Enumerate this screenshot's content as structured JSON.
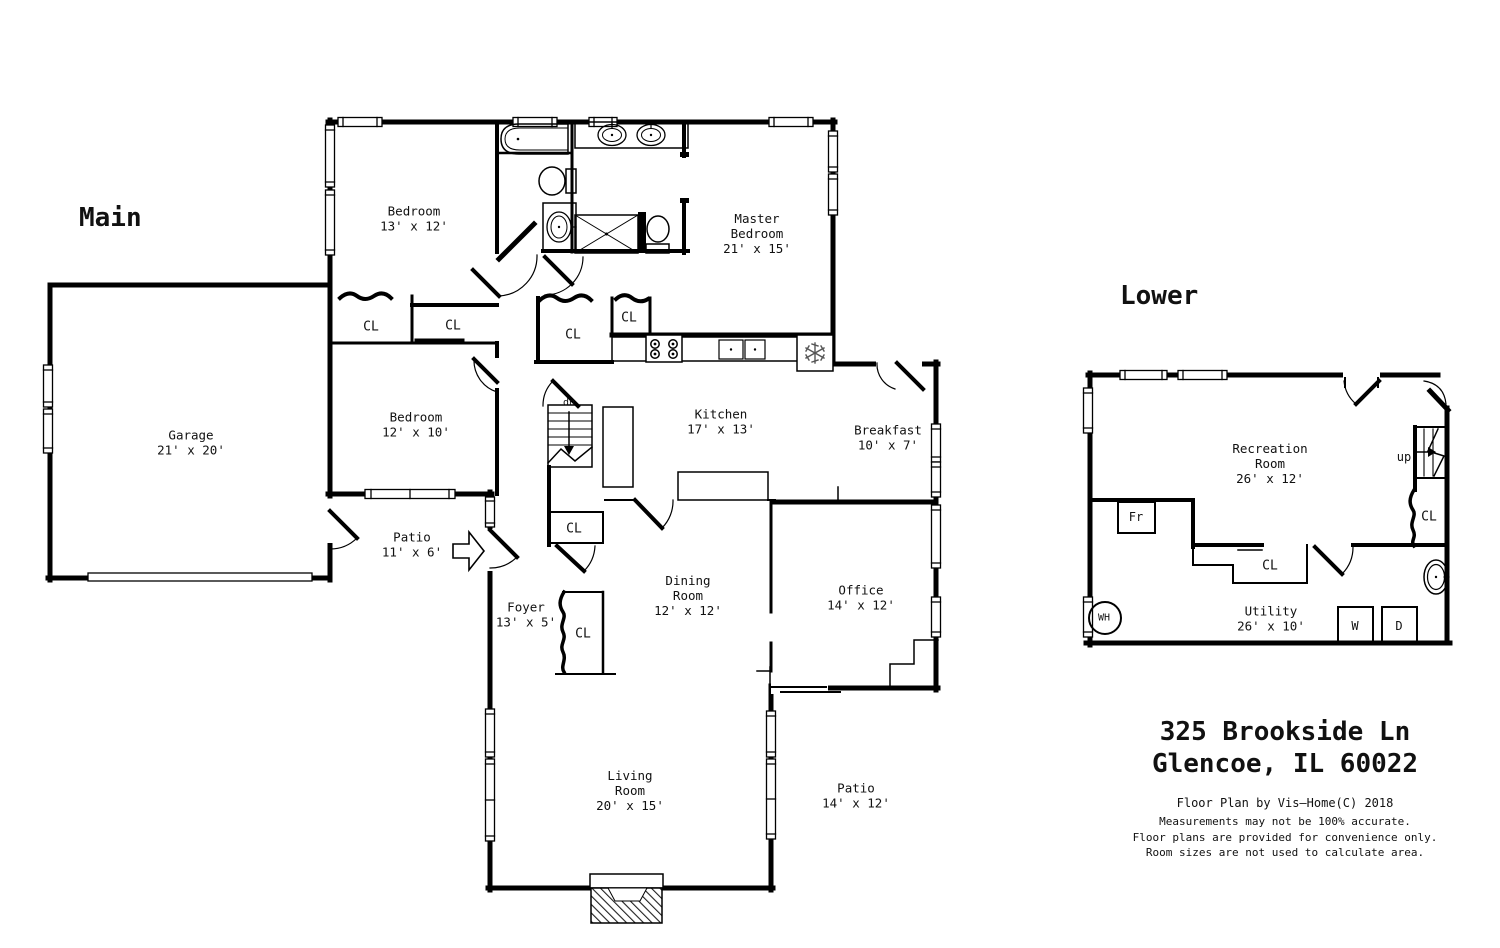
{
  "page": {
    "background": "#ffffff",
    "wall_color": "#000000",
    "fixture_color": "#555555"
  },
  "floors": {
    "main": {
      "title": "Main",
      "rooms": {
        "bedroom1": {
          "name": "Bedroom",
          "dims": "13' x 12'"
        },
        "master_bedroom": {
          "name": "Master Bedroom",
          "dims": "21' x 15'"
        },
        "garage": {
          "name": "Garage",
          "dims": "21' x 20'"
        },
        "bedroom2": {
          "name": "Bedroom",
          "dims": "12' x 10'"
        },
        "kitchen": {
          "name": "Kitchen",
          "dims": "17' x 13'"
        },
        "breakfast": {
          "name": "Breakfast",
          "dims": "10' x 7'"
        },
        "patio_side": {
          "name": "Patio",
          "dims": "11' x 6'"
        },
        "foyer": {
          "name": "Foyer",
          "dims": "13' x 5'"
        },
        "dining_room": {
          "name": "Dining Room",
          "dims": "12' x 12'"
        },
        "office": {
          "name": "Office",
          "dims": "14' x 12'"
        },
        "living_room": {
          "name": "Living Room",
          "dims": "20' x 15'"
        },
        "patio_rear": {
          "name": "Patio",
          "dims": "14' x 12'"
        }
      },
      "labels": {
        "closet": "CL",
        "stairs_down": "dn"
      }
    },
    "lower": {
      "title": "Lower",
      "rooms": {
        "recreation_room": {
          "name": "Recreation Room",
          "dims": "26' x 12'"
        },
        "utility": {
          "name": "Utility",
          "dims": "26' x 10'"
        }
      },
      "labels": {
        "closet": "CL",
        "stairs_up": "up",
        "freezer": "Fr",
        "water_heater": "WH",
        "washer": "W",
        "dryer": "D"
      }
    }
  },
  "footer": {
    "address_line1": "325 Brookside Ln",
    "address_line2": "Glencoe, IL 60022",
    "credit": "Floor Plan by Vis—Home(C) 2018",
    "disclaimer_line1": "Measurements may not be 100% accurate.",
    "disclaimer_line2": "Floor plans are provided for convenience only.",
    "disclaimer_line3": "Room sizes are not used to calculate area."
  }
}
